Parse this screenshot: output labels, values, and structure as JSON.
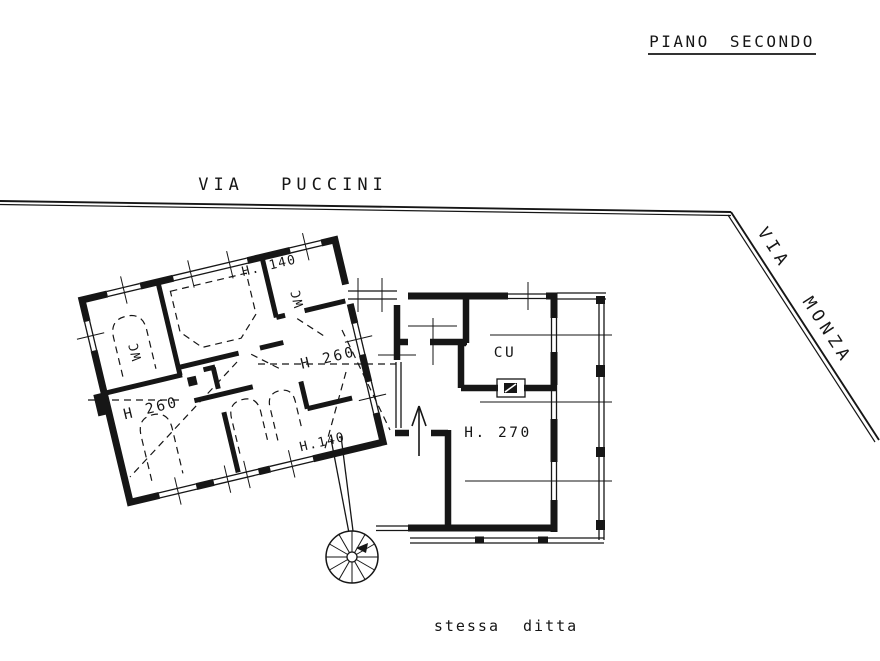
{
  "title": {
    "text": "PIANO SECONDO"
  },
  "streets": {
    "puccini": "VIA PUCCINI",
    "monza": "VIA MONZA"
  },
  "plan": {
    "left_building": {
      "labels": {
        "h140_top": "H. 140",
        "wc_top": "WC",
        "h260_right": "H 260",
        "wc_left": "WC",
        "h260_left": "H 260",
        "h140_bottom": "H.140"
      }
    },
    "right_building": {
      "labels": {
        "kitchen": "CU",
        "h270": "H. 270"
      }
    }
  },
  "footer": {
    "note": "stessa ditta"
  },
  "colors": {
    "ink": "#161616",
    "paper": "#ffffff"
  }
}
